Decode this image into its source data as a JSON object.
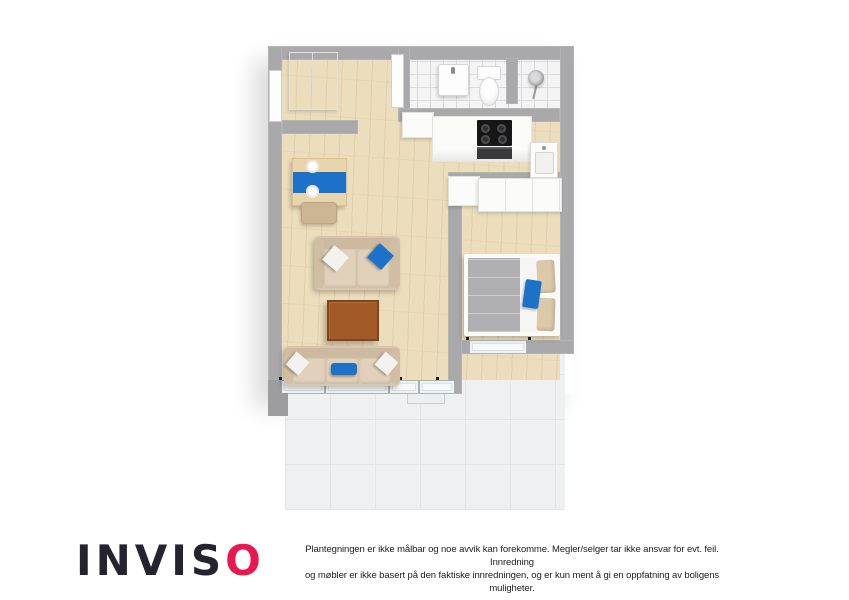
{
  "floorplan": {
    "type": "3d-top-down-floor-plan-render",
    "colors": {
      "wall": "#a9a9ab",
      "wood_floor": "#ecdebc",
      "bathroom_tile": "#f4f4f4",
      "terrace_tile": "#eef0f1",
      "sofa_beige": "#d8c6ae",
      "accent_blue": "#1b72c8",
      "coffee_table_brown": "#a15a28",
      "bed_duvet_gray": "#b0b0b3",
      "pillow_tan": "#dbc9a9",
      "cooktop_black": "#161616"
    },
    "rooms": [
      {
        "name": "hall",
        "furniture": [
          "wardrobe",
          "entry-door"
        ]
      },
      {
        "name": "bathroom",
        "furniture": [
          "wall-sink",
          "toilet",
          "bathroom-door"
        ]
      },
      {
        "name": "shower-room",
        "furniture": [
          "shower-head"
        ]
      },
      {
        "name": "kitchen",
        "furniture": [
          "counter",
          "cooktop",
          "oven",
          "kitchen-sink",
          "cabinet"
        ]
      },
      {
        "name": "living-room",
        "furniture": [
          "dining-table",
          "chair",
          "loveseat",
          "coffee-table",
          "sofa",
          "window-band"
        ]
      },
      {
        "name": "bedroom",
        "furniture": [
          "wardrobe",
          "cabinet",
          "double-bed",
          "window"
        ]
      },
      {
        "name": "terrace",
        "furniture": []
      }
    ]
  },
  "footer": {
    "logo": {
      "prefix": "INVIS",
      "accent_letter": "O",
      "text_color": "#262330",
      "accent_color": "#e9174f"
    },
    "disclaimer": {
      "line1": "Plantegningen er ikke målbar og noe avvik kan forekomme. Megler/selger tar ikke ansvar for evt. feil. Innredning",
      "line2": "og møbler er ikke basert på den faktiske innredningen, og er kun ment å gi en oppfatning av boligens muligheter."
    }
  }
}
